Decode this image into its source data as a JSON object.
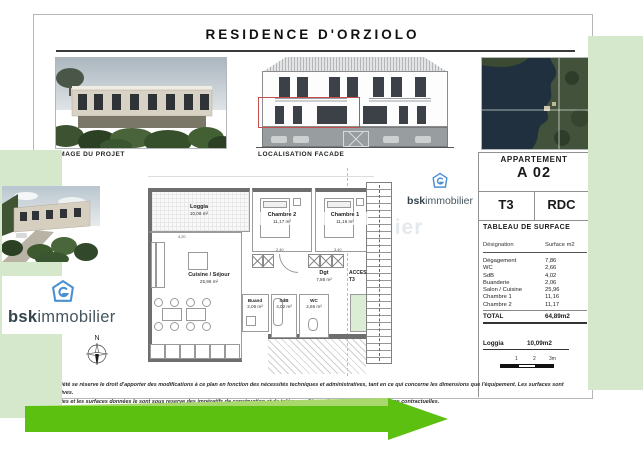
{
  "title": "RESIDENCE D'ORZIOLO",
  "labels": {
    "project_image": "IMAGE DU PROJET",
    "facade": "LOCALISATION FACADE"
  },
  "apartment": {
    "header": "APPARTEMENT",
    "code": "A 02",
    "type": "T3",
    "floor": "RDC"
  },
  "surface_table": {
    "title": "TABLEAU DE SURFACE",
    "columns": {
      "designation": "Désignation",
      "surface": "Surface m2"
    },
    "rows": [
      {
        "label": "Dégagement",
        "value": "7,86"
      },
      {
        "label": "WC",
        "value": "2,66"
      },
      {
        "label": "SdB",
        "value": "4,02"
      },
      {
        "label": "Buanderie",
        "value": "2,06"
      },
      {
        "label": "Salon / Cuisine",
        "value": "25,96"
      },
      {
        "label": "Chambre 1",
        "value": "11,16"
      },
      {
        "label": "Chambre 2",
        "value": "11,17"
      }
    ],
    "total": {
      "label": "TOTAL",
      "value": "64,89m2"
    },
    "loggia": {
      "label": "Loggia",
      "value": "10,09m2"
    }
  },
  "scale_bar": {
    "t1": "1",
    "t2": "2",
    "t3": "3m"
  },
  "floor_plan": {
    "loggia": {
      "name": "Loggia",
      "area": "10,09 m²"
    },
    "chambre2": {
      "name": "Chambre 2",
      "area": "11,17 m²"
    },
    "chambre1": {
      "name": "Chambre 1",
      "area": "11,16 m²"
    },
    "cuisine": {
      "name": "Cuisine / Séjour",
      "area": "25,96 m²"
    },
    "buanderie": {
      "name": "Buand",
      "area": "2,06 m²"
    },
    "degagement": {
      "name": "Dgt",
      "area": "7,86 m²"
    },
    "sdb": {
      "name": "SdB",
      "area": "4,02 m²"
    },
    "wc": {
      "name": "WC",
      "area": "2,66 m²"
    },
    "acces_line1": "ACCES",
    "acces_line2": "T3",
    "compass": "N",
    "dims": {
      "d1": "4,20",
      "d2": "2,40",
      "d3": "3,40"
    },
    "watermark": "bskimmobilier"
  },
  "brand": {
    "bold": "bsk",
    "rest": "immobilier"
  },
  "disclaimer": {
    "line1": "La société se réserve le droit d'apporter des modifications à ce plan en fonction des nécessités techniques et administratives, tant en ce qui concerne les dimensions que l'équipement. Les surfaces sont indicatives.",
    "line2": "Les côtes et les surfaces données le sont sous reserve des impératifs de construction et de tolérance d'éxecution. Les images ne sont pas contractuelles."
  },
  "colors": {
    "page_green": "#d5e8cb",
    "banner_green": "#5bc00f",
    "banner_light": "#a9d96d",
    "brand_blue": "#4a90d2",
    "facade_highlight_red": "#c4504e",
    "wall_gray": "#6e6e6e",
    "acces_green": "#dcedd6"
  }
}
